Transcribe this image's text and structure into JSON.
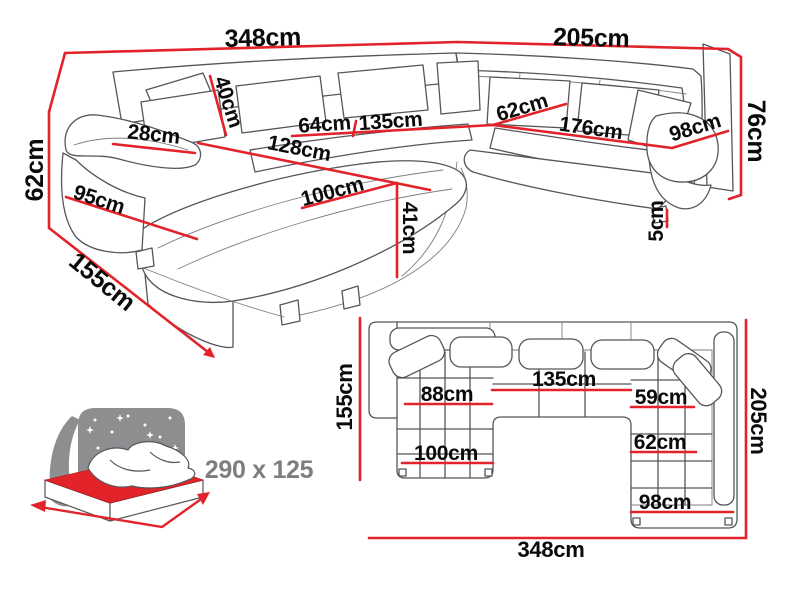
{
  "colors": {
    "dimension_red": "#e2232a",
    "sketch_gray": "#55565a",
    "label_black": "#0a0a0a",
    "bed_gray": "#8d8e90",
    "bed_label_gray": "#7c7e82"
  },
  "perspective": {
    "total_width": "348cm",
    "right_width": "205cm",
    "back_height": "76cm",
    "arm_height": "62cm",
    "arm_depth": "95cm",
    "arm_top_width": "28cm",
    "back_cushion_height": "40cm",
    "seat_depth": "64cm",
    "middle_seat_width": "135cm",
    "chaise_back_length": "128cm",
    "chaise_seat_length": "100cm",
    "seat_height": "41cm",
    "corner_seat_width": "62cm",
    "right_seat_width": "176cm",
    "right_section_width": "98cm",
    "leg_height": "5cm",
    "chaise_depth": "155cm"
  },
  "plan": {
    "left_depth": "155cm",
    "total_width": "348cm",
    "right_depth": "205cm",
    "middle_seat_width": "135cm",
    "chaise_width": "88cm",
    "corner_seat_width": "59cm",
    "right_seat_depth": "62cm",
    "right_section_width": "98cm",
    "chaise_length": "100cm"
  },
  "sleeping_area": {
    "dimensions": "290 x 125"
  }
}
